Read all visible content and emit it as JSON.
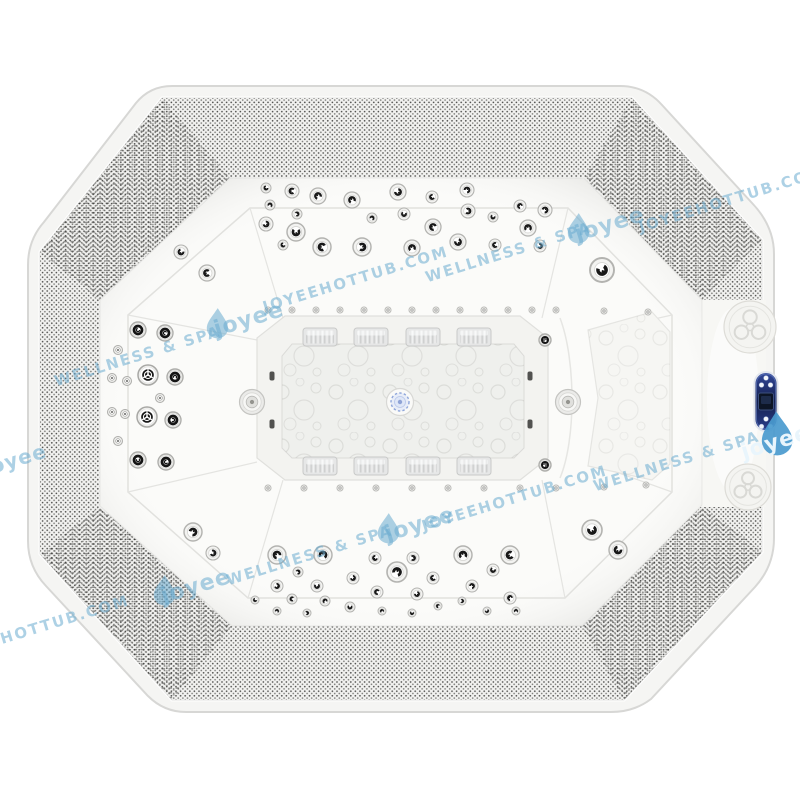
{
  "meta": {
    "description": "Top view product photo of an octagonal white hot tub spa with chrome massage jets",
    "background": "#ffffff"
  },
  "watermark": {
    "brand": "joyee",
    "tagline": "WELLNESS & SPA",
    "website": "JOYEEHOTTUB.COM",
    "light_color": "rgba(105,172,208,0.55)",
    "dark_color": "#4a9ace",
    "angle_deg": -17,
    "items": [
      {
        "kind": "tagline",
        "x": 510,
        "y": 257,
        "size": 15
      },
      {
        "kind": "logo",
        "x": 598,
        "y": 227,
        "size": 22
      },
      {
        "kind": "website",
        "x": 733,
        "y": 204,
        "size": 15
      },
      {
        "kind": "tagline",
        "x": 139,
        "y": 361,
        "size": 15
      },
      {
        "kind": "logo",
        "x": 237,
        "y": 322,
        "size": 22
      },
      {
        "kind": "website",
        "x": 357,
        "y": 284,
        "size": 15
      },
      {
        "kind": "logo",
        "x": 4,
        "y": 463,
        "size": 20
      },
      {
        "kind": "tagline",
        "x": 678,
        "y": 466,
        "size": 15
      },
      {
        "kind": "logo-dark",
        "x": 777,
        "y": 437,
        "size": 30
      },
      {
        "kind": "website",
        "x": 38,
        "y": 633,
        "size": 15
      },
      {
        "kind": "logo",
        "x": 184,
        "y": 589,
        "size": 22
      },
      {
        "kind": "tagline",
        "x": 311,
        "y": 560,
        "size": 15
      },
      {
        "kind": "logo",
        "x": 408,
        "y": 527,
        "size": 22
      },
      {
        "kind": "website",
        "x": 516,
        "y": 503,
        "size": 15
      }
    ]
  },
  "tub": {
    "shape": "octagon",
    "shell_color": "#f5f5f3",
    "deck_color": "#fbfbf9",
    "band_texture": "perforated",
    "drain": {
      "x": 400,
      "y": 402,
      "led_color": "#8fa3d6"
    },
    "control_panel": {
      "x": 766,
      "y": 401,
      "body_color": "#1a2a63",
      "button_color": "#f2f5fa",
      "display_color": "#0d1526"
    },
    "medallions": [
      [
        750,
        327,
        26
      ],
      [
        748,
        487,
        23
      ]
    ],
    "counts": {
      "swirl_jets": 62,
      "ring_jets": 8,
      "spinner_jets": 2,
      "mini_jets": 7,
      "air_injectors": 26,
      "suction_slots": 4,
      "side_fittings": 2,
      "clear_jet_blocks": 8,
      "drain": 1,
      "control_panel": 1
    },
    "jets": {
      "swirl": [
        [
          266,
          188,
          5
        ],
        [
          292,
          191,
          7
        ],
        [
          318,
          196,
          8
        ],
        [
          270,
          205,
          5
        ],
        [
          297,
          214,
          5
        ],
        [
          266,
          224,
          7
        ],
        [
          296,
          232,
          9
        ],
        [
          283,
          245,
          5
        ],
        [
          322,
          247,
          9
        ],
        [
          352,
          200,
          8
        ],
        [
          372,
          218,
          5
        ],
        [
          362,
          247,
          9
        ],
        [
          398,
          192,
          8
        ],
        [
          404,
          214,
          6
        ],
        [
          432,
          197,
          6
        ],
        [
          433,
          227,
          8
        ],
        [
          412,
          248,
          8
        ],
        [
          467,
          190,
          7
        ],
        [
          468,
          211,
          7
        ],
        [
          458,
          242,
          8
        ],
        [
          493,
          217,
          5
        ],
        [
          495,
          245,
          6
        ],
        [
          520,
          206,
          6
        ],
        [
          528,
          228,
          8
        ],
        [
          545,
          210,
          7
        ],
        [
          540,
          246,
          6
        ],
        [
          602,
          270,
          12
        ],
        [
          181,
          252,
          7
        ],
        [
          207,
          273,
          8
        ],
        [
          277,
          555,
          9
        ],
        [
          323,
          555,
          9
        ],
        [
          298,
          572,
          5
        ],
        [
          277,
          586,
          6
        ],
        [
          317,
          586,
          6
        ],
        [
          255,
          600,
          4
        ],
        [
          292,
          599,
          5
        ],
        [
          325,
          601,
          5
        ],
        [
          277,
          611,
          4
        ],
        [
          307,
          613,
          4
        ],
        [
          353,
          578,
          6
        ],
        [
          350,
          607,
          5
        ],
        [
          375,
          558,
          6
        ],
        [
          377,
          592,
          6
        ],
        [
          382,
          611,
          4
        ],
        [
          397,
          572,
          10
        ],
        [
          413,
          558,
          6
        ],
        [
          417,
          594,
          6
        ],
        [
          412,
          613,
          4
        ],
        [
          433,
          578,
          6
        ],
        [
          438,
          606,
          4
        ],
        [
          463,
          555,
          9
        ],
        [
          472,
          586,
          6
        ],
        [
          462,
          601,
          4
        ],
        [
          487,
          611,
          4
        ],
        [
          493,
          570,
          6
        ],
        [
          510,
          555,
          9
        ],
        [
          510,
          598,
          6
        ],
        [
          516,
          611,
          4
        ],
        [
          193,
          532,
          9
        ],
        [
          213,
          553,
          7
        ],
        [
          592,
          530,
          10
        ],
        [
          618,
          550,
          9
        ]
      ],
      "ring": [
        [
          138,
          330,
          8
        ],
        [
          165,
          333,
          8
        ],
        [
          175,
          377,
          8
        ],
        [
          173,
          420,
          8
        ],
        [
          138,
          460,
          8
        ],
        [
          166,
          462,
          8
        ],
        [
          545,
          340,
          6
        ],
        [
          545,
          465,
          6
        ]
      ],
      "spinner": [
        [
          148,
          375,
          10
        ],
        [
          147,
          417,
          10
        ]
      ],
      "mini": [
        [
          118,
          350
        ],
        [
          112,
          378
        ],
        [
          127,
          381
        ],
        [
          160,
          398
        ],
        [
          112,
          412
        ],
        [
          125,
          414
        ],
        [
          118,
          441
        ]
      ],
      "air": [
        [
          268,
          310
        ],
        [
          292,
          310
        ],
        [
          316,
          310
        ],
        [
          340,
          310
        ],
        [
          364,
          310
        ],
        [
          388,
          310
        ],
        [
          412,
          310
        ],
        [
          436,
          310
        ],
        [
          460,
          310
        ],
        [
          484,
          310
        ],
        [
          508,
          310
        ],
        [
          532,
          310
        ],
        [
          556,
          310
        ],
        [
          604,
          311
        ],
        [
          648,
          312
        ],
        [
          268,
          488
        ],
        [
          304,
          488
        ],
        [
          340,
          488
        ],
        [
          376,
          488
        ],
        [
          412,
          488
        ],
        [
          448,
          488
        ],
        [
          484,
          488
        ],
        [
          520,
          488
        ],
        [
          556,
          488
        ],
        [
          604,
          487
        ],
        [
          646,
          485
        ]
      ],
      "slot": [
        [
          272,
          376
        ],
        [
          272,
          424
        ],
        [
          530,
          376
        ],
        [
          530,
          424
        ]
      ],
      "disc": [
        [
          252,
          402
        ],
        [
          568,
          402
        ]
      ],
      "block": [
        [
          320,
          337
        ],
        [
          371,
          337
        ],
        [
          423,
          337
        ],
        [
          474,
          337
        ],
        [
          320,
          466
        ],
        [
          371,
          466
        ],
        [
          423,
          466
        ],
        [
          474,
          466
        ]
      ]
    }
  }
}
